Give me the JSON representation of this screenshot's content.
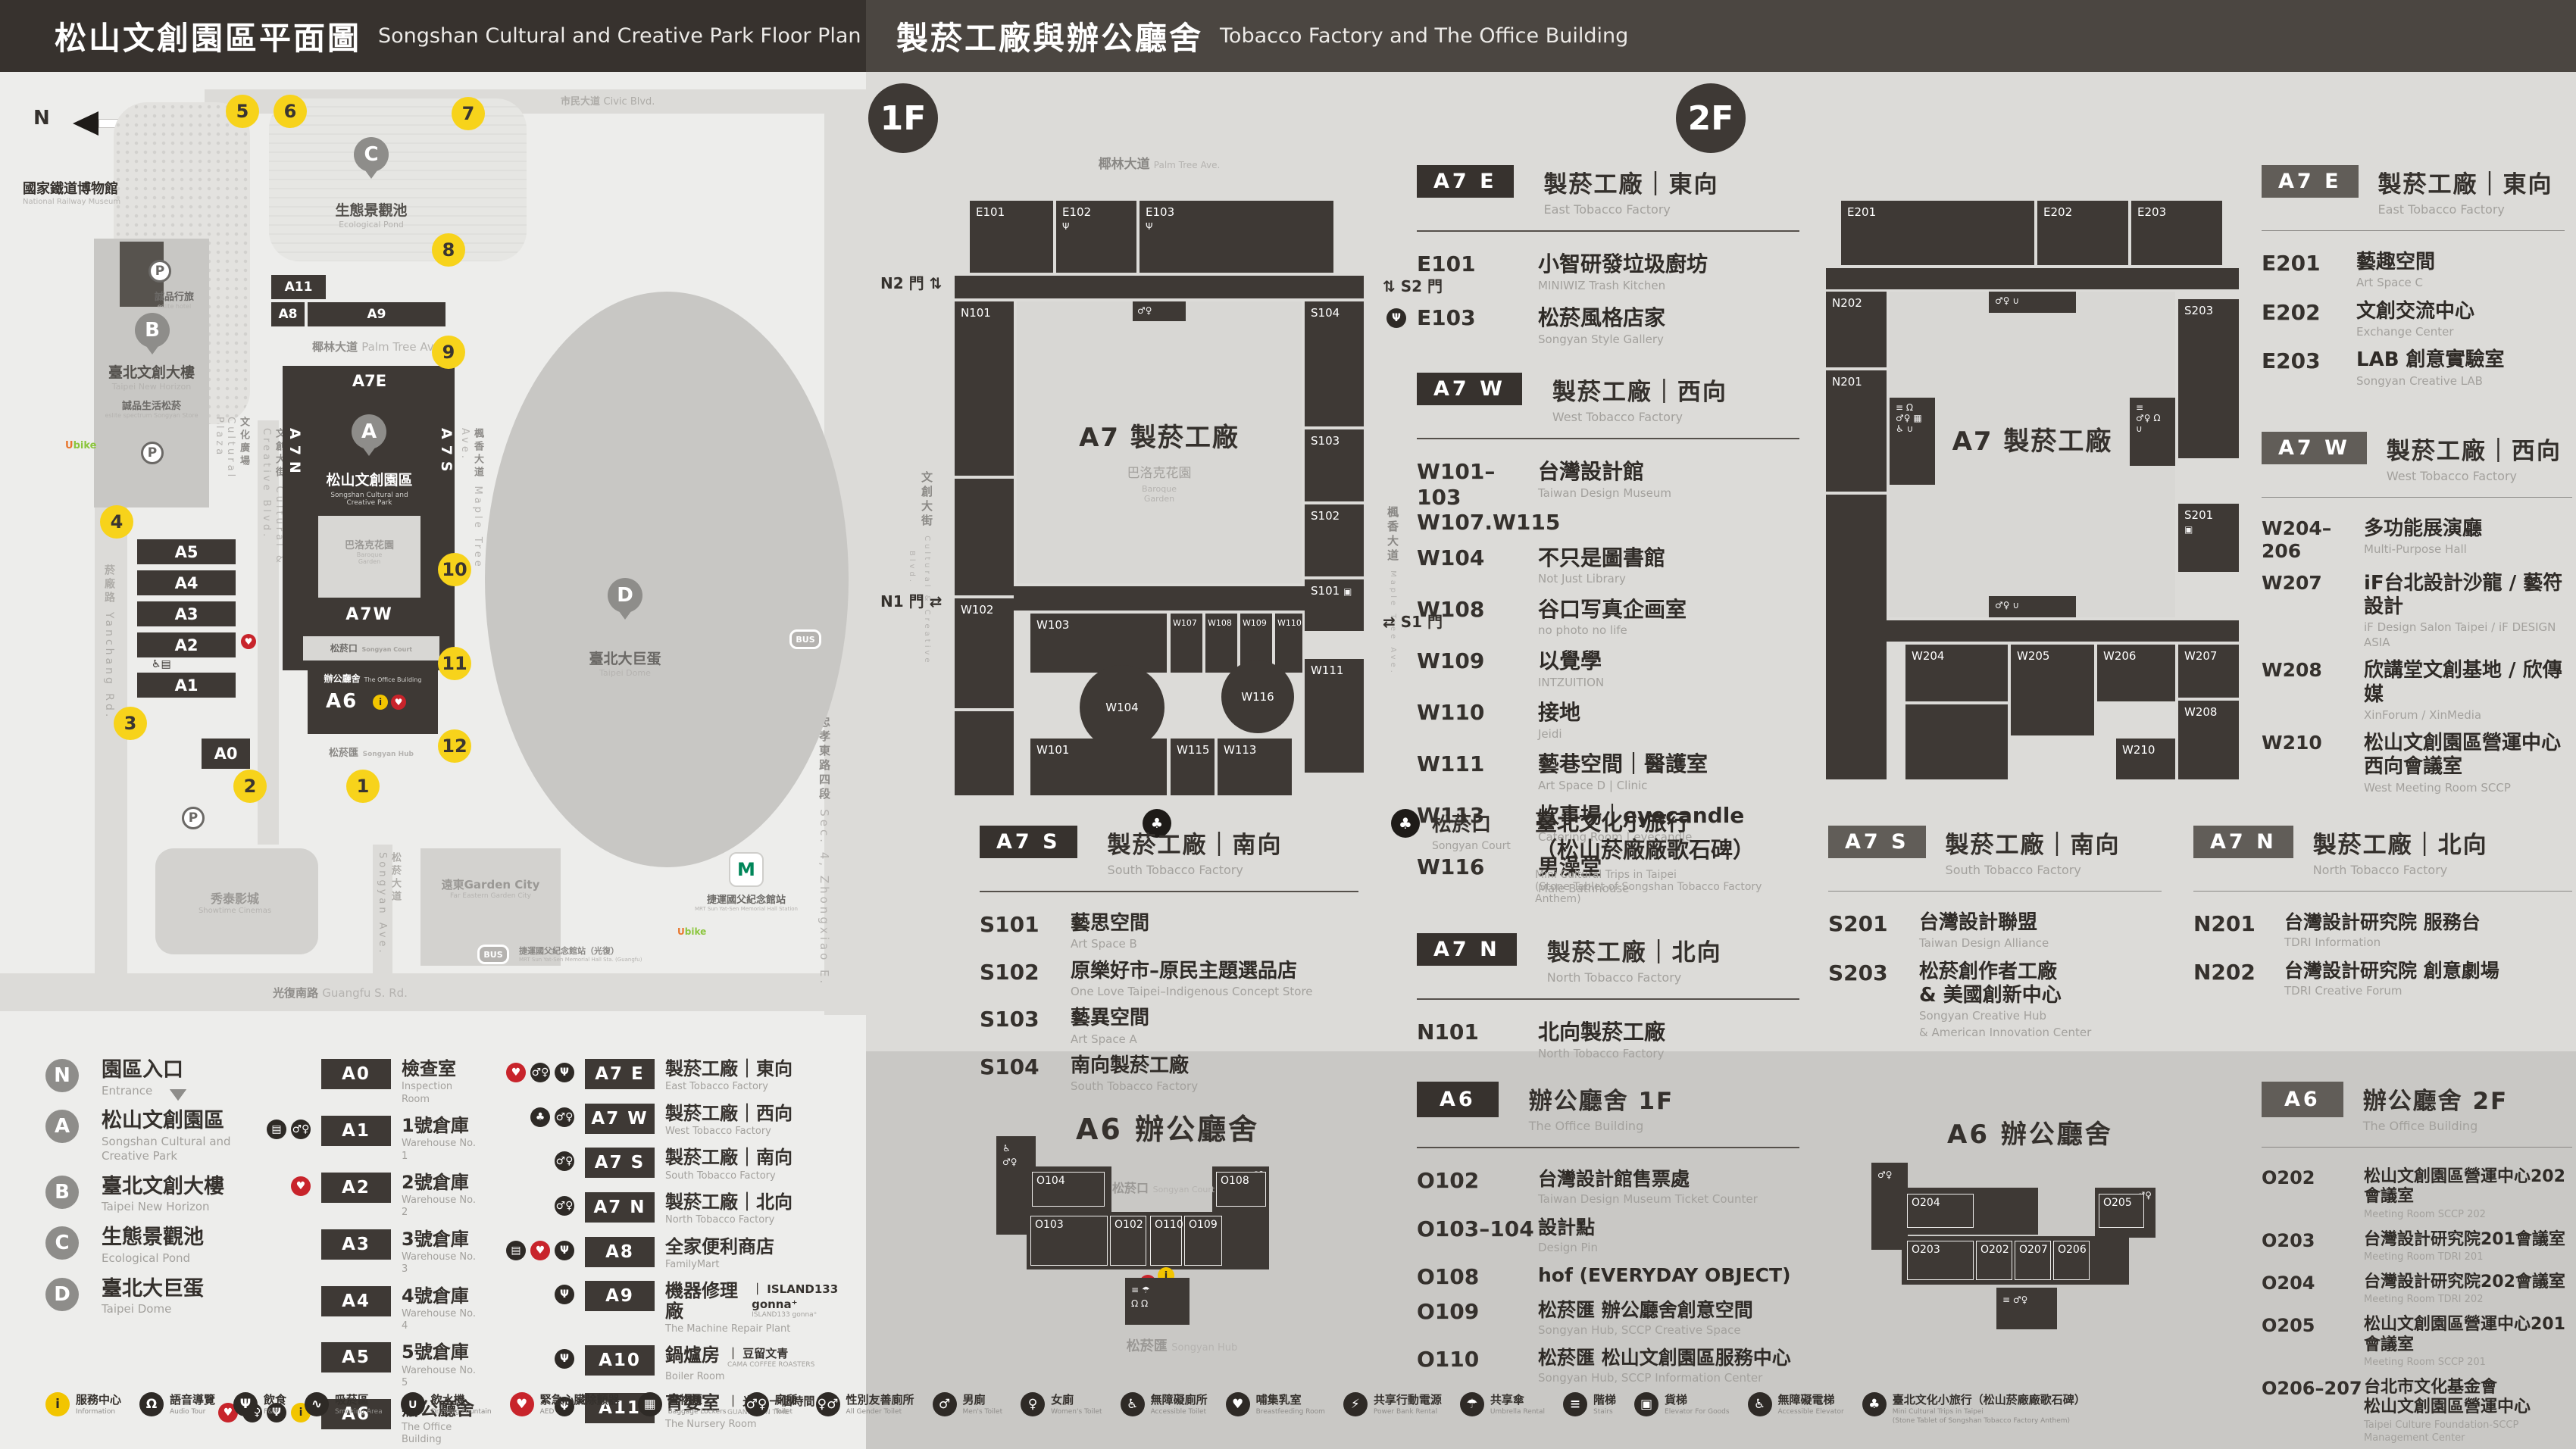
{
  "colors": {
    "accent_yellow": "#f7d31b",
    "aed_red": "#c8242b",
    "dark": "#3a3531"
  },
  "header": {
    "left_title_zh": "松山文創園區平面圖",
    "left_title_en": "Songshan Cultural and Creative Park Floor Plan",
    "right_title_zh": "製菸工廠與辦公廳舍",
    "right_title_en": "Tobacco Factory and The Office Building"
  },
  "map": {
    "compass": "N",
    "railway_museum_zh": "國家鐵道博物館",
    "railway_museum_en": "National Railway Museum",
    "eslite_hotel_zh": "誠品行旅",
    "eslite_hotel_en": "eslite hotel",
    "new_horizon_zh": "臺北文創大樓",
    "new_horizon_en": "Taipei New Horizon",
    "eslite_spectrum_zh": "誠品生活松菸",
    "eslite_spectrum_en": "eslite spectrum Songyan Store",
    "cultural_plaza_zh": "文化廣場",
    "cultural_plaza_en": "Cultural Plaza",
    "pond_zh": "生態景觀池",
    "pond_en": "Ecological Pond",
    "palm_ave_zh": "椰林大道",
    "palm_ave_en": "Palm Tree Ave.",
    "park_zh": "松山文創園區",
    "park_en1": "Songshan Cultural and",
    "park_en2": "Creative Park",
    "baroque_zh": "巴洛克花園",
    "baroque_en1": "Baroque",
    "baroque_en2": "Garden",
    "court_zh": "松菸口",
    "court_en": "Songyan Court",
    "office_zh": "辦公廳舍",
    "office_en": "The Office Building",
    "hub_zh": "松菸匯",
    "hub_en": "Songyan Hub",
    "dome_zh": "臺北大巨蛋",
    "dome_en": "Taipei Dome",
    "garden_city_zh": "遠東Garden City",
    "garden_city_en": "Far Eastern Garden City",
    "showtime_zh": "秀泰影城",
    "showtime_en": "Showtime Cinemas",
    "mrt_zh": "捷運國父紀念館站",
    "mrt_en": "MRT Sun Yat-Sen Memorial Hall Station",
    "bus_stop_zh": "捷運國父紀念館站（光復）",
    "bus_stop_en": "MRT Sun Yat-Sen Memorial Hall Sta. (Guangfu)",
    "ubike": "Ubike",
    "bus": "BUS",
    "metro": "M",
    "roads": {
      "civic_zh": "市民大道",
      "civic_en": "Civic Blvd.",
      "yanchang_zh": "菸廠路",
      "yanchang_en": "Yanchang Rd.",
      "guangfu_zh": "光復南路",
      "guangfu_en": "Guangfu S. Rd.",
      "zhongxiao_zh": "忠孝東路四段",
      "zhongxiao_en": "Sec. 4, Zhongxiao E. Rd.",
      "cc_blvd_zh": "文創大街",
      "cc_blvd_en": "Cultural & Creative Blvd.",
      "songyan_ave_zh": "松菸大道",
      "songyan_ave_en": "Songyan Ave.",
      "maple_ave_zh": "楓香大道",
      "maple_ave_en": "Maple Tree Ave."
    },
    "blocks": {
      "a11": "A11",
      "a8": "A8",
      "a9": "A9",
      "a7e": "A7E",
      "a7w": "A7W",
      "a7n": "A7N",
      "a7s": "A7S",
      "a6": "A6",
      "a5": "A5",
      "a4": "A4",
      "a3": "A3",
      "a2": "A2",
      "a1": "A1",
      "a0": "A0"
    },
    "entrances": [
      "1",
      "2",
      "3",
      "4",
      "5",
      "6",
      "7",
      "8",
      "9",
      "10",
      "11",
      "12"
    ],
    "parking": "P",
    "pin_a": "A",
    "pin_b": "B",
    "pin_c": "C",
    "pin_d": "D"
  },
  "legend": {
    "pins": [
      {
        "id": "N",
        "zh": "園區入口",
        "en": "Entrance",
        "kind": "entrance"
      },
      {
        "id": "A",
        "zh": "松山文創園區",
        "en": "Songshan Cultural and Creative Park",
        "kind": "pin"
      },
      {
        "id": "B",
        "zh": "臺北文創大樓",
        "en": "Taipei New Horizon",
        "kind": "pin"
      },
      {
        "id": "C",
        "zh": "生態景觀池",
        "en": "Ecological Pond",
        "kind": "pin"
      },
      {
        "id": "D",
        "zh": "臺北大巨蛋",
        "en": "Taipei Dome",
        "kind": "pin"
      }
    ],
    "col1": [
      {
        "code": "A0",
        "zh": "檢查室",
        "en": "Inspection Room",
        "icons": []
      },
      {
        "code": "A1",
        "zh": "1號倉庫",
        "en": "Warehouse No. 1",
        "icons": [
          "elevator",
          "toilet"
        ]
      },
      {
        "code": "A2",
        "zh": "2號倉庫",
        "en": "Warehouse No. 2",
        "icons": [
          "aed"
        ]
      },
      {
        "code": "A3",
        "zh": "3號倉庫",
        "en": "Warehouse No. 3",
        "icons": []
      },
      {
        "code": "A4",
        "zh": "4號倉庫",
        "en": "Warehouse No. 4",
        "icons": []
      },
      {
        "code": "A5",
        "zh": "5號倉庫",
        "en": "Warehouse No. 5",
        "icons": []
      },
      {
        "code": "A6",
        "zh": "辦公廳舍",
        "en": "The Office Building",
        "icons": [
          "aed",
          "toilet",
          "fnb",
          "info"
        ]
      }
    ],
    "col2": [
      {
        "code": "A7 E",
        "zh": "製菸工廠｜東向",
        "en": "East Tobacco Factory",
        "icons": [
          "aed",
          "toilet",
          "fnb"
        ]
      },
      {
        "code": "A7 W",
        "zh": "製菸工廠｜西向",
        "en": "West Tobacco Factory",
        "icons": [
          "trip",
          "toilet"
        ]
      },
      {
        "code": "A7 S",
        "zh": "製菸工廠｜南向",
        "en": "South Tobacco Factory",
        "icons": [
          "toilet"
        ]
      },
      {
        "code": "A7 N",
        "zh": "製菸工廠｜北向",
        "en": "North Tobacco Factory",
        "icons": [
          "toilet"
        ]
      },
      {
        "code": "A8",
        "zh": "全家便利商店",
        "en": "FamilyMart",
        "icons": [
          "elevator",
          "aed",
          "fnb"
        ]
      },
      {
        "code": "A9",
        "zh": "機器修理廠",
        "en": "The Machine Repair Plant",
        "icons": [
          "fnb"
        ],
        "note_zh": "｜ ISLAND133 gonna⁺",
        "note_en": "ISLAND133 gonna⁺"
      },
      {
        "code": "A10",
        "zh": "鍋爐房",
        "en": "Boiler Room",
        "icons": [
          "fnb"
        ],
        "note_zh": "｜ 豆留文青",
        "note_en": "CAMA COFFEE ROASTERS"
      },
      {
        "code": "A11",
        "zh": "育嬰室",
        "en": "The Nursery Room",
        "icons": [
          "fnb"
        ],
        "note_zh": "｜ 光一 一個時間",
        "note_en": "GUANG YI IN TIME"
      }
    ]
  },
  "facilities": [
    {
      "zh": "服務中心",
      "en": "Information",
      "icon": "info"
    },
    {
      "zh": "語音導覽",
      "en": "Audio Tour",
      "icon": "audio"
    },
    {
      "zh": "飲食",
      "en": "F&B",
      "icon": "fnb"
    },
    {
      "zh": "吸菸區",
      "en": "Smoking Area",
      "icon": "smoking"
    },
    {
      "zh": "飲水機",
      "en": "Drinking Fountain",
      "icon": "fountain"
    },
    {
      "zh": "緊急心臟除顫器",
      "en": "AED",
      "icon": "aed"
    },
    {
      "zh": "置物櫃",
      "en": "Baggage Lockers",
      "icon": "locker"
    },
    {
      "zh": "廁所",
      "en": "Toilet",
      "icon": "toilet"
    },
    {
      "zh": "性別友善廁所",
      "en": "All Gender Toilet",
      "icon": "allgender"
    },
    {
      "zh": "男廁",
      "en": "Men's Toilet",
      "icon": "mens"
    },
    {
      "zh": "女廁",
      "en": "Women's Toilet",
      "icon": "womens"
    },
    {
      "zh": "無障礙廁所",
      "en": "Accessible Toilet",
      "icon": "accessible"
    },
    {
      "zh": "哺集乳室",
      "en": "Breastfeeding Room",
      "icon": "nursing"
    },
    {
      "zh": "共享行動電源",
      "en": "Power Bank Rental",
      "icon": "power"
    },
    {
      "zh": "共享傘",
      "en": "Umbrella Rental",
      "icon": "umbrella"
    },
    {
      "zh": "階梯",
      "en": "Stairs",
      "icon": "stairs"
    },
    {
      "zh": "貨梯",
      "en": "Elevator For Goods",
      "icon": "goods-elevator"
    },
    {
      "zh": "無障礙電梯",
      "en": "Accessible Elevator",
      "icon": "accessible-elevator"
    },
    {
      "zh": "臺北文化小旅行（松山菸廠廠歌石碑）",
      "en": "Mini Cultural Trips in Taipei",
      "en2": "(Stone Tablet of Songshan Tobacco Factory Anthem)",
      "icon": "trip"
    }
  ],
  "floor1": {
    "badge": "1F",
    "plan": {
      "street_top_zh": "椰林大道",
      "street_top_en": "Palm Tree Ave.",
      "street_left_zh": "文創大街",
      "street_left_en": "Cultural & Creative Blvd.",
      "street_right_zh": "楓香大道",
      "street_right_en": "Maple Tree Ave.",
      "gate_n2": "N2 門",
      "gate_s2": "S2 門",
      "gate_n1": "N1 門",
      "gate_s1": "S1 門",
      "center": "A7 製菸工廠",
      "garden_zh": "巴洛克花園",
      "garden_en1": "Baroque",
      "garden_en2": "Garden",
      "rooms": {
        "e101": "E101",
        "e102": "E102",
        "e103": "E103",
        "n101": "N101",
        "s104": "S104",
        "s103": "S103",
        "s102": "S102",
        "s101": "S101",
        "w111": "W111",
        "w102": "W102",
        "w103": "W103",
        "w107": "W107",
        "w108": "W108",
        "w109": "W109",
        "w110": "W110",
        "w104": "W104",
        "w116": "W116",
        "w101": "W101",
        "w115": "W115",
        "w113": "W113"
      }
    },
    "a7e": {
      "chip": "A7 E",
      "zh": "製菸工廠｜東向",
      "en": "East Tobacco Factory",
      "items": [
        {
          "code": "E101",
          "zh": "小智研發垃圾廚坊",
          "en": "MINIWIZ Trash Kitchen"
        },
        {
          "code": "E103",
          "zh": "松菸風格店家",
          "en": "Songyan Style Gallery",
          "icon": "fnb"
        }
      ]
    },
    "a7w": {
      "chip": "A7 W",
      "zh": "製菸工廠｜西向",
      "en": "West Tobacco Factory",
      "items": [
        {
          "code": "W101–103",
          "code2": "W107.W115",
          "zh": "台灣設計館",
          "en": "Taiwan Design Museum"
        },
        {
          "code": "W104",
          "zh": "不只是圖書館",
          "en": "Not Just Library"
        },
        {
          "code": "W108",
          "zh": "谷口写真企画室",
          "en": "no photo no life"
        },
        {
          "code": "W109",
          "zh": "以覺學",
          "en": "INTZUITION"
        },
        {
          "code": "W110",
          "zh": "接地",
          "en": "Jeidi"
        },
        {
          "code": "W111",
          "zh": "藝巷空間｜醫護室",
          "en": "Art Space D | Clinic"
        },
        {
          "code": "W113",
          "zh": "炊事場｜eyecandle",
          "en": "Catering Room | eyecandle"
        },
        {
          "code": "W116",
          "zh": "男澡堂",
          "en": "Male Bathhouse"
        }
      ]
    },
    "a7s": {
      "chip": "A7 S",
      "zh": "製菸工廠｜南向",
      "en": "South Tobacco Factory",
      "items": [
        {
          "code": "S101",
          "zh": "藝思空間",
          "en": "Art Space B"
        },
        {
          "code": "S102",
          "zh": "原樂好市–原民主題選品店",
          "en": "One Love Taipei–Indigenous Concept Store"
        },
        {
          "code": "S103",
          "zh": "藝異空間",
          "en": "Art Space A"
        },
        {
          "code": "S104",
          "zh": "南向製菸工廠",
          "en": "South Tobacco Factory"
        }
      ]
    },
    "court": {
      "label_zh": "松菸口",
      "label_en": "Songyan Court",
      "zh1": "臺北文化小旅行",
      "zh2": "（松山菸廠廠歌石碑）",
      "en1": "Mini Cultural Trips in Taipei",
      "en2": "(Stone Tablet of Songshan Tobacco Factory Anthem)"
    },
    "a7n": {
      "chip": "A7 N",
      "zh": "製菸工廠｜北向",
      "en": "North Tobacco Factory",
      "items": [
        {
          "code": "N101",
          "zh": "北向製菸工廠",
          "en": "North Tobacco Factory"
        }
      ]
    },
    "a6": {
      "chip": "A6",
      "zh": "辦公廳舍 1F",
      "en": "The Office Building",
      "plan_title": "A6 辦公廳舍",
      "court_zh": "松菸口",
      "court_en": "Songyan Court",
      "hub_zh": "松菸匯",
      "hub_en": "Songyan Hub",
      "rooms": {
        "o104": "O104",
        "o103": "O103",
        "o102": "O102",
        "o110": "O110",
        "o109": "O109",
        "o108": "O108"
      },
      "items": [
        {
          "code": "O102",
          "zh": "台灣設計館售票處",
          "en": "Taiwan Design Museum Ticket Counter"
        },
        {
          "code": "O103–104",
          "zh": "設計點",
          "en": "Design Pin"
        },
        {
          "code": "O108",
          "zh": "hof (EVERYDAY OBJECT)"
        },
        {
          "code": "O109",
          "zh": "松菸匯 辦公廳舍創意空間",
          "en": "Songyan Hub, SCCP Creative Space"
        },
        {
          "code": "O110",
          "zh": "松菸匯 松山文創園區服務中心",
          "en": "Songyan Hub, SCCP Information Center"
        }
      ]
    }
  },
  "floor2": {
    "badge": "2F",
    "plan": {
      "center": "A7 製菸工廠",
      "rooms": {
        "e201": "E201",
        "e202": "E202",
        "e203": "E203",
        "n202": "N202",
        "n201": "N201",
        "s203": "S203",
        "s201": "S201",
        "w204": "W204",
        "w205": "W205",
        "w206": "W206",
        "w207": "W207",
        "w208": "W208",
        "w210": "W210"
      }
    },
    "a7e": {
      "chip": "A7 E",
      "zh": "製菸工廠｜東向",
      "en": "East Tobacco Factory",
      "items": [
        {
          "code": "E201",
          "zh": "藝趣空間",
          "en": "Art Space C"
        },
        {
          "code": "E202",
          "zh": "文創交流中心",
          "en": "Exchange Center"
        },
        {
          "code": "E203",
          "zh": "LAB 創意實驗室",
          "en": "Songyan Creative LAB"
        }
      ]
    },
    "a7w": {
      "chip": "A7 W",
      "zh": "製菸工廠｜西向",
      "en": "West Tobacco Factory",
      "items": [
        {
          "code": "W204–206",
          "zh": "多功能展演廳",
          "en": "Multi-Purpose Hall"
        },
        {
          "code": "W207",
          "zh": "iF台北設計沙龍 / 藝符設計",
          "en": "iF Design Salon Taipei / iF DESIGN ASIA"
        },
        {
          "code": "W208",
          "zh": "欣講堂文創基地 / 欣傳媒",
          "en": "XinForum / XinMedia"
        },
        {
          "code": "W210",
          "zh": "松山文創園區營運中心",
          "zh2": "西向會議室",
          "en": "West Meeting Room SCCP"
        }
      ]
    },
    "a7s": {
      "chip": "A7 S",
      "zh": "製菸工廠｜南向",
      "en": "South Tobacco Factory",
      "items": [
        {
          "code": "S201",
          "zh": "台灣設計聯盟",
          "en": "Taiwan Design Alliance"
        },
        {
          "code": "S203",
          "zh": "松菸創作者工廠",
          "zh2": "& 美國創新中心",
          "en": "Songyan Creative Hub",
          "en2": "& American Innovation Center"
        }
      ]
    },
    "a7n": {
      "chip": "A7 N",
      "zh": "製菸工廠｜北向",
      "en": "North Tobacco Factory",
      "items": [
        {
          "code": "N201",
          "zh": "台灣設計研究院 服務台",
          "en": "TDRI Information"
        },
        {
          "code": "N202",
          "zh": "台灣設計研究院 創意劇場",
          "en": "TDRI Creative Forum"
        }
      ]
    },
    "a6": {
      "chip": "A6",
      "zh": "辦公廳舍 2F",
      "en": "The Office Building",
      "plan_title": "A6 辦公廳舍",
      "rooms": {
        "o204": "O204",
        "o203": "O203",
        "o202": "O202",
        "o207": "O207",
        "o206": "O206",
        "o205": "O205"
      },
      "items": [
        {
          "code": "O202",
          "zh": "松山文創園區營運中心202會議室",
          "en": "Meeting Room SCCP 202"
        },
        {
          "code": "O203",
          "zh": "台灣設計研究院201會議室",
          "en": "Meeting Room TDRI 201"
        },
        {
          "code": "O204",
          "zh": "台灣設計研究院202會議室",
          "en": "Meeting Room TDRI 202"
        },
        {
          "code": "O205",
          "zh": "松山文創園區營運中心201會議室",
          "en": "Meeting Room SCCP 201"
        },
        {
          "code": "O206–207",
          "zh": "台北市文化基金會",
          "zh2": "松山文創園區營運中心",
          "en": "Taipei Culture Foundation-SCCP Management Center"
        },
        {
          "code": "O302",
          "badge": "3F",
          "zh": "松山文創園區營運中心301會議室",
          "en": "Meeting Room SCCP 301"
        }
      ]
    }
  }
}
